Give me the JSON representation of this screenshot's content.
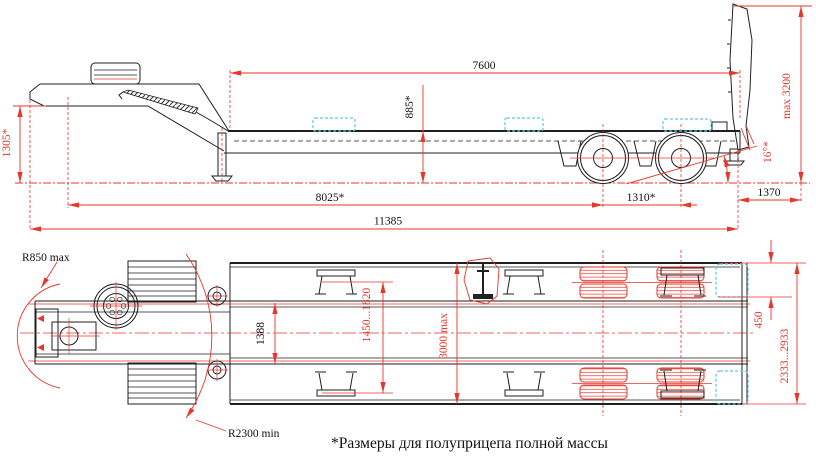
{
  "drawing": {
    "title_hint": "low-bed semitrailer two-view dimension drawing",
    "footnote": "*Размеры для полуприцепа полной массы",
    "colors": {
      "dimension_red": "#e5372b",
      "line_black": "#1f1f1f",
      "accent_cyan": "#5fc9db",
      "background": "#ffffff"
    },
    "side_view": {
      "dims": {
        "platform_length": "7600",
        "deck_height": "885*",
        "ramp_height": "max 3200",
        "gooseneck_height": "1305*",
        "kingpin_base": "8025*",
        "axle_spacing": "1310*",
        "rear_overhang": "1370",
        "overall_length": "11385",
        "departure_angle": "16°*"
      }
    },
    "top_view": {
      "dims": {
        "front_radius": "R850 max",
        "rear_radius": "R2300 min",
        "frame_width": "1388",
        "adjustable_width": "1450...1820",
        "overall_width": "3000 max",
        "rear_gap": "450",
        "rear_width_range": "2333...2933"
      }
    }
  }
}
